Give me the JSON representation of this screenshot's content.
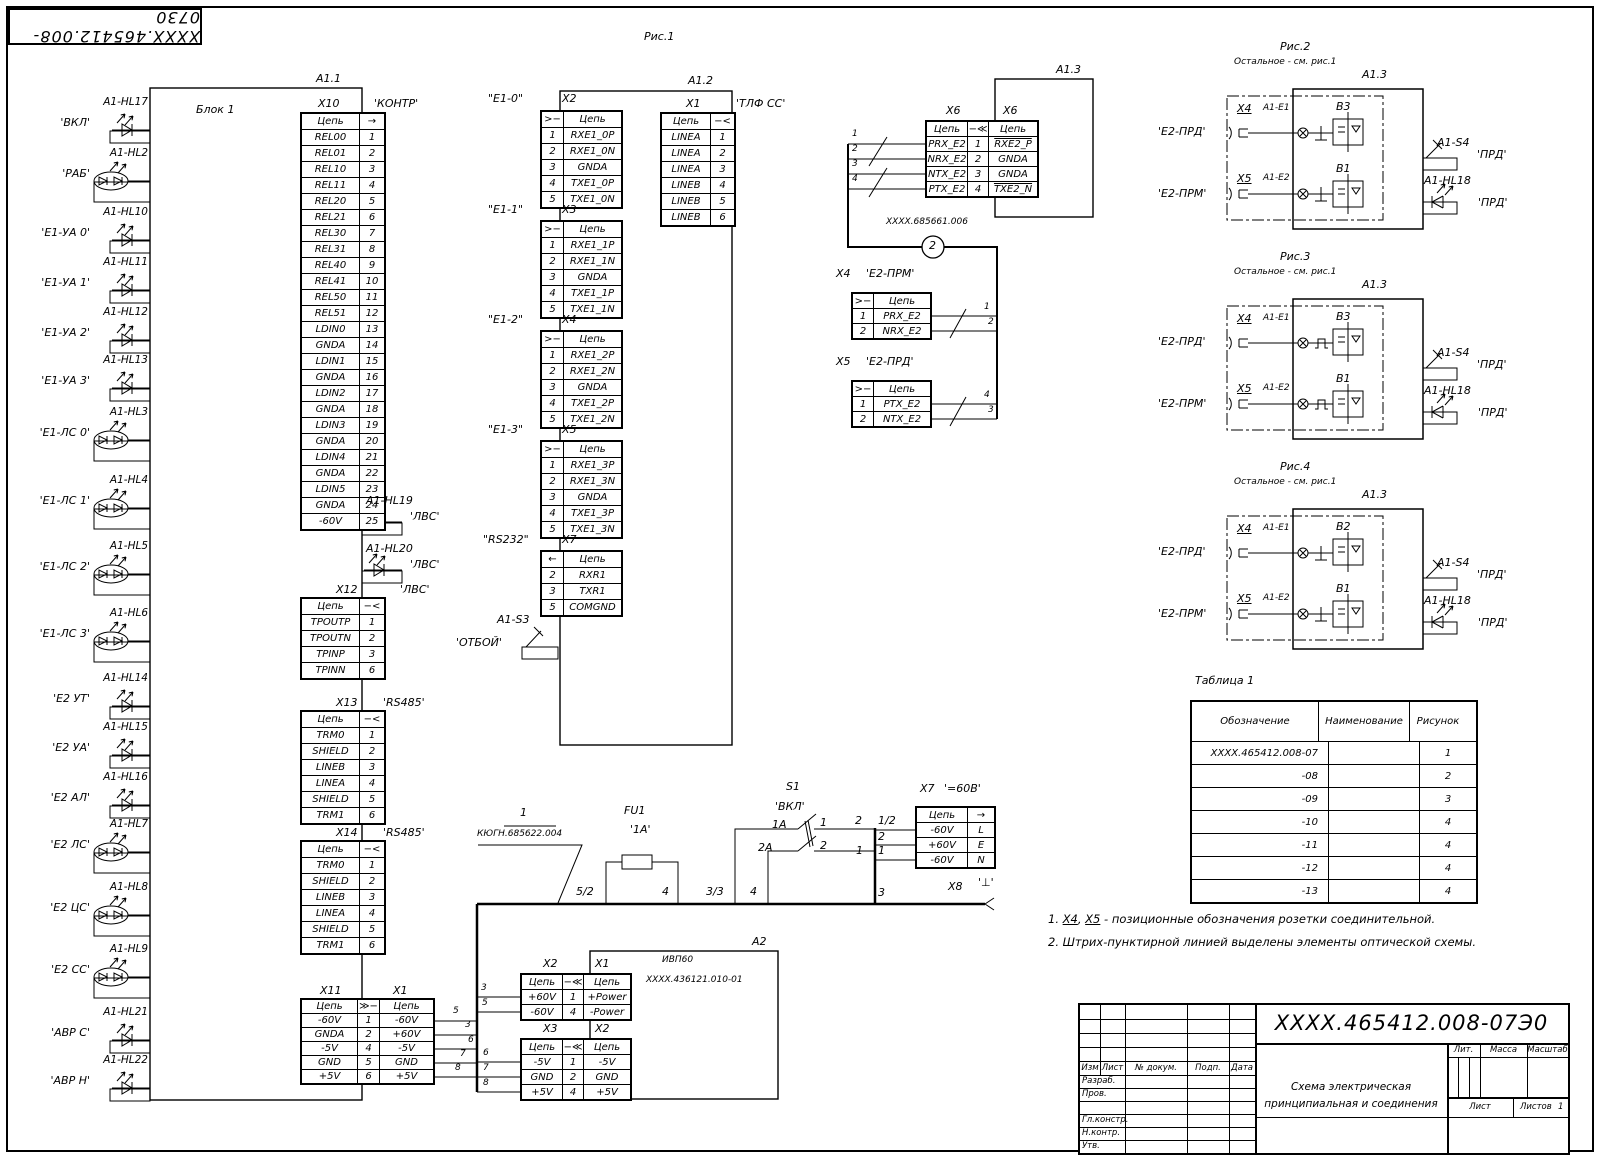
{
  "sheet": {
    "stamp": "ХХХХ.465412.008-0730",
    "fig1": "Рис.1"
  },
  "blocks": {
    "a11": {
      "ref": "A1.1",
      "name": "Блок 1"
    },
    "a12": {
      "ref": "A1.2"
    },
    "a13": {
      "ref": "A1.3"
    },
    "a2": {
      "ref": "A2",
      "line1": "ИВП60",
      "line2": "ХХХХ.436121.010-01"
    }
  },
  "indicators": [
    {
      "designator": "A1-HL17",
      "label": "'ВКЛ'",
      "type": "single"
    },
    {
      "designator": "A1-HL2",
      "label": "'РАБ'",
      "type": "double"
    },
    {
      "designator": "A1-HL10",
      "label": "'Е1-УА 0'",
      "type": "single"
    },
    {
      "designator": "A1-HL11",
      "label": "'Е1-УА 1'",
      "type": "single"
    },
    {
      "designator": "A1-HL12",
      "label": "'Е1-УА 2'",
      "type": "single"
    },
    {
      "designator": "A1-HL13",
      "label": "'Е1-УА 3'",
      "type": "single"
    },
    {
      "designator": "A1-HL3",
      "label": "'Е1-ЛС 0'",
      "type": "double"
    },
    {
      "designator": "A1-HL4",
      "label": "'Е1-ЛС 1'",
      "type": "double"
    },
    {
      "designator": "A1-HL5",
      "label": "'Е1-ЛС 2'",
      "type": "double"
    },
    {
      "designator": "A1-HL6",
      "label": "'Е1-ЛС 3'",
      "type": "double"
    },
    {
      "designator": "A1-HL14",
      "label": "'Е2 УТ'",
      "type": "single"
    },
    {
      "designator": "A1-HL15",
      "label": "'Е2 УА'",
      "type": "single"
    },
    {
      "designator": "A1-HL16",
      "label": "'Е2 АЛ'",
      "type": "single"
    },
    {
      "designator": "A1-HL7",
      "label": "'Е2 ЛС'",
      "type": "double"
    },
    {
      "designator": "A1-HL8",
      "label": "'Е2 ЦС'",
      "type": "double"
    },
    {
      "designator": "A1-HL9",
      "label": "'Е2 СС'",
      "type": "double"
    },
    {
      "designator": "A1-HL21",
      "label": "'АВР С'",
      "type": "single"
    },
    {
      "designator": "A1-HL22",
      "label": "'АВР Н'",
      "type": "single"
    }
  ],
  "right_leds": [
    {
      "designator": "A1-HL19",
      "label": "'ЛВС'"
    },
    {
      "designator": "A1-HL20",
      "label": "'ЛВС'"
    }
  ],
  "switches": {
    "s3": {
      "designator": "A1-S3",
      "label": "'ОТБОЙ'"
    },
    "s1": {
      "designator": "S1",
      "label": "'ВКЛ'",
      "fuse": "FU1",
      "fuse_rating": "'1А'"
    }
  },
  "tables": {
    "x10": {
      "des": "X10",
      "tag": "'КОНТР'",
      "header": [
        "Цепь",
        "→"
      ],
      "rows": [
        [
          "REL00",
          "1"
        ],
        [
          "REL01",
          "2"
        ],
        [
          "REL10",
          "3"
        ],
        [
          "REL11",
          "4"
        ],
        [
          "REL20",
          "5"
        ],
        [
          "REL21",
          "6"
        ],
        [
          "REL30",
          "7"
        ],
        [
          "REL31",
          "8"
        ],
        [
          "REL40",
          "9"
        ],
        [
          "REL41",
          "10"
        ],
        [
          "REL50",
          "11"
        ],
        [
          "REL51",
          "12"
        ],
        [
          "LDIN0",
          "13"
        ],
        [
          "GNDA",
          "14"
        ],
        [
          "LDIN1",
          "15"
        ],
        [
          "GNDA",
          "16"
        ],
        [
          "LDIN2",
          "17"
        ],
        [
          "GNDA",
          "18"
        ],
        [
          "LDIN3",
          "19"
        ],
        [
          "GNDA",
          "20"
        ],
        [
          "LDIN4",
          "21"
        ],
        [
          "GNDA",
          "22"
        ],
        [
          "LDIN5",
          "23"
        ],
        [
          "GNDA",
          "24"
        ],
        [
          "-60V",
          "25"
        ]
      ]
    },
    "x12": {
      "des": "X12",
      "tag": "'ЛВС'",
      "header": [
        "Цепь",
        "−<"
      ],
      "rows": [
        [
          "TPOUTP",
          "1"
        ],
        [
          "TPOUTN",
          "2"
        ],
        [
          "TPINP",
          "3"
        ],
        [
          "TPINN",
          "6"
        ]
      ]
    },
    "x13": {
      "des": "X13",
      "tag": "'RS485'",
      "header": [
        "Цепь",
        "−<"
      ],
      "rows": [
        [
          "TRM0",
          "1"
        ],
        [
          "SHIELD",
          "2"
        ],
        [
          "LINEB",
          "3"
        ],
        [
          "LINEA",
          "4"
        ],
        [
          "SHIELD",
          "5"
        ],
        [
          "TRM1",
          "6"
        ]
      ]
    },
    "x14": {
      "des": "X14",
      "tag": "'RS485'",
      "header": [
        "Цепь",
        "−<"
      ],
      "rows": [
        [
          "TRM0",
          "1"
        ],
        [
          "SHIELD",
          "2"
        ],
        [
          "LINEB",
          "3"
        ],
        [
          "LINEA",
          "4"
        ],
        [
          "SHIELD",
          "5"
        ],
        [
          "TRM1",
          "6"
        ]
      ]
    },
    "x11": {
      "des": "X11",
      "des2": "X1",
      "header": [
        "Цепь",
        "≫−",
        "Цепь"
      ],
      "rows": [
        [
          "-60V",
          "1",
          "-60V"
        ],
        [
          "GNDA",
          "2",
          "+60V"
        ],
        [
          "-5V",
          "4",
          "-5V"
        ],
        [
          "GND",
          "5",
          "GND"
        ],
        [
          "+5V",
          "6",
          "+5V"
        ]
      ]
    },
    "e1_0": {
      "tag": "\"Е1-0\"",
      "des": "X2",
      "header": [
        ">−",
        "Цепь"
      ],
      "rows": [
        [
          "1",
          "RXE1_0P"
        ],
        [
          "2",
          "RXE1_0N"
        ],
        [
          "3",
          "GNDA"
        ],
        [
          "4",
          "TXE1_0P"
        ],
        [
          "5",
          "TXE1_0N"
        ]
      ]
    },
    "e1_1": {
      "tag": "\"Е1-1\"",
      "des": "X3",
      "header": [
        ">−",
        "Цепь"
      ],
      "rows": [
        [
          "1",
          "RXE1_1P"
        ],
        [
          "2",
          "RXE1_1N"
        ],
        [
          "3",
          "GNDA"
        ],
        [
          "4",
          "TXE1_1P"
        ],
        [
          "5",
          "TXE1_1N"
        ]
      ]
    },
    "e1_2": {
      "tag": "\"Е1-2\"",
      "des": "X4",
      "header": [
        ">−",
        "Цепь"
      ],
      "rows": [
        [
          "1",
          "RXE1_2P"
        ],
        [
          "2",
          "RXE1_2N"
        ],
        [
          "3",
          "GNDA"
        ],
        [
          "4",
          "TXE1_2P"
        ],
        [
          "5",
          "TXE1_2N"
        ]
      ]
    },
    "e1_3": {
      "tag": "\"Е1-3\"",
      "des": "X5",
      "header": [
        ">−",
        "Цепь"
      ],
      "rows": [
        [
          "1",
          "RXE1_3P"
        ],
        [
          "2",
          "RXE1_3N"
        ],
        [
          "3",
          "GNDA"
        ],
        [
          "4",
          "TXE1_3P"
        ],
        [
          "5",
          "TXE1_3N"
        ]
      ]
    },
    "rs232": {
      "tag": "\"RS232\"",
      "des": "X7",
      "header": [
        "←",
        "Цепь"
      ],
      "rows": [
        [
          "2",
          "RXR1"
        ],
        [
          "3",
          "TXR1"
        ],
        [
          "5",
          "COMGND"
        ]
      ]
    },
    "tlf": {
      "des": "X1",
      "tag": "'ТЛФ СС'",
      "header": [
        "Цепь",
        "−<"
      ],
      "rows": [
        [
          "LINEA",
          "1"
        ],
        [
          "LINEA",
          "2"
        ],
        [
          "LINEA",
          "3"
        ],
        [
          "LINEB",
          "4"
        ],
        [
          "LINEB",
          "5"
        ],
        [
          "LINEB",
          "6"
        ]
      ]
    },
    "x6": {
      "des": "X6",
      "des2": "X6",
      "header": [
        "Цепь",
        "−≪",
        "Цепь"
      ],
      "rows": [
        [
          "PRX_E2",
          "1",
          "^RXE2_P"
        ],
        [
          "NRX_E2",
          "2",
          "GNDA"
        ],
        [
          "NTX_E2",
          "3",
          "GNDA"
        ],
        [
          "PTX_E2",
          "4",
          "^TXE2_N"
        ]
      ]
    },
    "e2prm": {
      "des": "X4",
      "tag": "'Е2-ПРМ'",
      "header": [
        ">−",
        "Цепь"
      ],
      "rows": [
        [
          "1",
          "PRX_E2"
        ],
        [
          "2",
          "NRX_E2"
        ]
      ]
    },
    "e2prd": {
      "des": "X5",
      "tag": "'Е2-ПРД'",
      "header": [
        ">−",
        "Цепь"
      ],
      "rows": [
        [
          "1",
          "PTX_E2"
        ],
        [
          "2",
          "NTX_E2"
        ]
      ]
    },
    "x7pwr": {
      "des": "X7",
      "tag": "'=60В'",
      "header": [
        "Цепь",
        "→"
      ],
      "rows": [
        [
          "-60V",
          "L"
        ],
        [
          "+60V",
          "E"
        ],
        [
          "-60V",
          "N"
        ]
      ]
    },
    "a2x2": {
      "des": "X2",
      "des2": "X1",
      "header": [
        "Цепь",
        "−≪",
        "Цепь"
      ],
      "rows": [
        [
          "+60V",
          "1",
          "+Power"
        ],
        [
          "-60V",
          "4",
          "-Power"
        ]
      ]
    },
    "a2x3": {
      "des": "X3",
      "des2": "X2",
      "header": [
        "Цепь",
        "−≪",
        "Цепь"
      ],
      "rows": [
        [
          "-5V",
          "1",
          "-5V"
        ],
        [
          "GND",
          "2",
          "GND"
        ],
        [
          "+5V",
          "4",
          "+5V"
        ]
      ]
    }
  },
  "table1": {
    "title": "Таблица 1",
    "header": [
      "Обозначение",
      "Наименование",
      "Рисунок"
    ],
    "rows": [
      [
        "ХХХХ.465412.008-07",
        "",
        "1"
      ],
      [
        "-08",
        "",
        "2"
      ],
      [
        "-09",
        "",
        "3"
      ],
      [
        "-10",
        "",
        "4"
      ],
      [
        "-11",
        "",
        "4"
      ],
      [
        "-12",
        "",
        "4"
      ],
      [
        "-13",
        "",
        "4"
      ]
    ]
  },
  "cables": {
    "c1_num": "1",
    "c1_code": "КЮГН.685622.004",
    "c2_num": "2",
    "c2_code": "ХХХХ.685661.006"
  },
  "x8": {
    "des": "X8",
    "tag": "'⊥'"
  },
  "wires": {
    "x6": [
      "1",
      "2",
      "3",
      "4"
    ],
    "e2": [
      "1",
      "2",
      "4",
      "3"
    ],
    "x11_left": [
      "5",
      "3",
      "6",
      "7",
      "8"
    ],
    "x11_right": [
      "3",
      "5",
      "6",
      "7",
      "8"
    ],
    "bus": {
      "fu_in": "5/2",
      "fu_out": "4",
      "s1_in1": "3/3",
      "s1_in2": "4",
      "s1_c1": "1А",
      "s1_c2": "2А",
      "s1_o1": "1",
      "s1_o2": "2",
      "l_left": "2",
      "l_right": "1/2",
      "e_mid": "2",
      "n_left": "1",
      "n_right": "1",
      "gnd_j": "3"
    }
  },
  "figures": [
    {
      "title": "Рис.2",
      "subtitle": "Остальное - см. рис.1",
      "ref": "A1.3",
      "x4": "X4",
      "x4_el": "A1-E1",
      "in_top": "'Е2-ПРД'",
      "x5": "X5",
      "x5_el": "A1-E2",
      "in_bot": "'Е2-ПРМ'",
      "b_top": "B3",
      "b_bot": "B1",
      "s4": "A1-S4",
      "s4_label": "'ПРД'",
      "hl18": "A1-HL18",
      "hl18_label": "'ПРД'"
    },
    {
      "title": "Рис.3",
      "subtitle": "Остальное - см. рис.1",
      "ref": "A1.3",
      "x4": "X4",
      "x4_el": "A1-E1",
      "in_top": "'Е2-ПРД'",
      "x5": "X5",
      "x5_el": "A1-E2",
      "in_bot": "'Е2-ПРМ'",
      "b_top": "B3",
      "b_bot": "B1",
      "s4": "A1-S4",
      "s4_label": "'ПРД'",
      "hl18": "A1-HL18",
      "hl18_label": "'ПРД'"
    },
    {
      "title": "Рис.4",
      "subtitle": "Остальное - см. рис.1",
      "ref": "A1.3",
      "x4": "X4",
      "x4_el": "A1-E1",
      "in_top": "'Е2-ПРД'",
      "x5": "X5",
      "x5_el": "A1-E2",
      "in_bot": "'Е2-ПРМ'",
      "b_top": "B2",
      "b_bot": "B1",
      "s4": "A1-S4",
      "s4_label": "'ПРД'",
      "hl18": "A1-HL18",
      "hl18_label": "'ПРД'"
    }
  ],
  "notes": {
    "n1_pre": "1. ",
    "n1_x4": "X4",
    "n1_sep": ", ",
    "n1_x5": "X5",
    "n1_rest": " - позиционные обозначения розетки соединительной.",
    "n2": "2. Штрих-пунктирной линией выделены элементы оптической схемы."
  },
  "titleblock": {
    "doc": "ХХХХ.465412.008-07Э0",
    "name1": "Схема электрическая",
    "name2": "принципиальная и соединения",
    "c_izm": "Изм",
    "c_list": "Лист",
    "c_ndoc": "№ докум.",
    "c_podp": "Подп.",
    "c_data": "Дата",
    "r1": "Разраб.",
    "r2": "Пров.",
    "r3": "Гл.констр.",
    "r4": "Н.контр.",
    "r5": "Утв.",
    "lit": "Лит.",
    "massa": "Масса",
    "masshtab": "Масштаб",
    "list": "Лист",
    "listov": "Листов",
    "listov_n": "1"
  }
}
